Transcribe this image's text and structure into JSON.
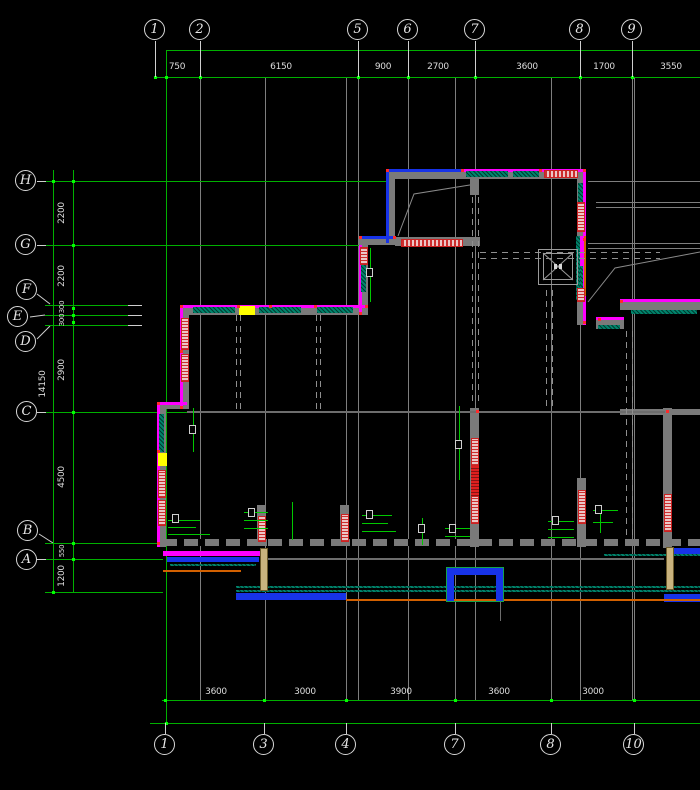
{
  "canvas": {
    "width": 700,
    "height": 790,
    "background": "#000000"
  },
  "palette": {
    "dim_green": "#00B000",
    "node_green": "#00FF00",
    "grid_gray": "#7E7E7E",
    "wall_gray": "#7A7A7A",
    "outline_magenta": "#FF00FF",
    "beam_blue": "#1733E8",
    "hatch_teal": "#00846C",
    "column_red": "#DF1F1F",
    "label_pink": "#ECC6C6",
    "accent_orange": "#D26000",
    "accent_yellow": "#FFFF00",
    "door_tan": "#C9B37E",
    "text_white": "#E0E0E0"
  },
  "axes": {
    "top": {
      "bubbles": [
        "1",
        "2",
        "5",
        "6",
        "7",
        "8",
        "9"
      ],
      "dims": [
        "750",
        "6150",
        "900",
        "2700",
        "3600",
        "1700",
        "3550"
      ]
    },
    "bottom": {
      "bubbles": [
        "1",
        "3",
        "4",
        "7",
        "8",
        "10"
      ],
      "dims": [
        "3600",
        "3000",
        "3900",
        "3600",
        "3000"
      ]
    },
    "left": {
      "bubbles": [
        "H",
        "G",
        "F",
        "E",
        "D",
        "C",
        "B",
        "A"
      ],
      "dims": [
        "2200",
        "2200",
        "300",
        "300",
        "2900",
        "4500",
        "550",
        "1200"
      ],
      "overall": "14150"
    }
  }
}
